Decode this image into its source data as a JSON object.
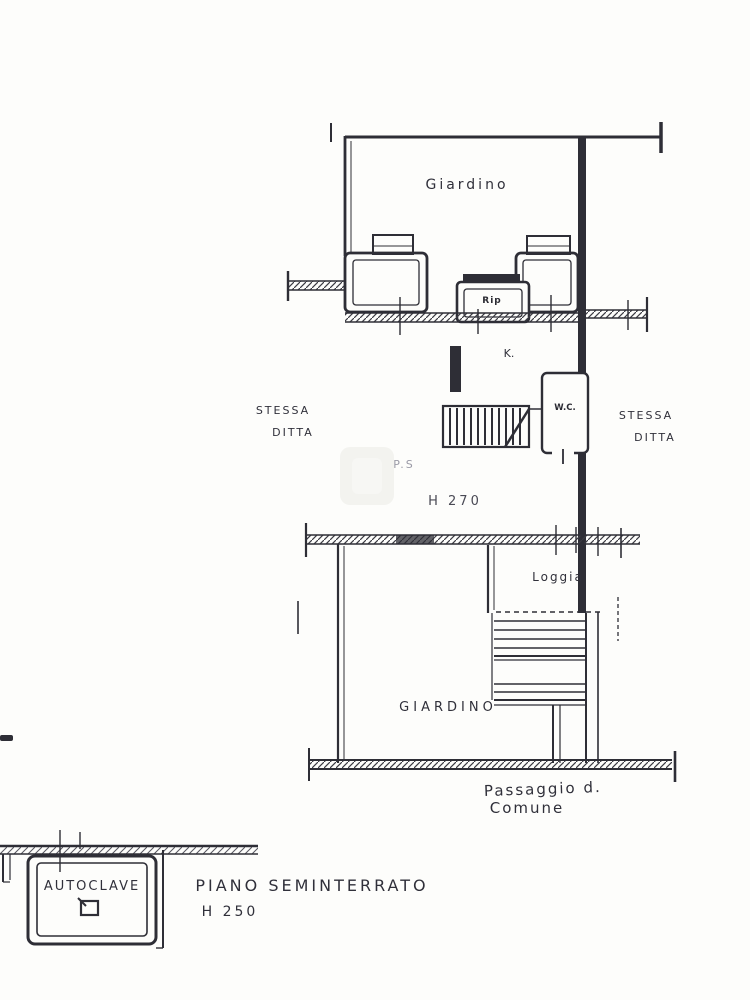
{
  "plan": {
    "labels": {
      "garden_top": "Giardino",
      "rip": "Rip",
      "kitchen": "K.",
      "wc": "W.C.",
      "stessa_left_1": "STESSA",
      "stessa_left_2": "DITTA",
      "stessa_right_1": "STESSA",
      "stessa_right_2": "DITTA",
      "room_code": "P.S",
      "room_height": "H 270",
      "loggia": "Loggia",
      "garden_bottom": "GIARDINO",
      "passage_line1": "Passaggio d.",
      "passage_line2": "Comune"
    },
    "basement": {
      "autoclave": "AUTOCLAVE",
      "floor_title": "PIANO SEMINTERRATO",
      "floor_height": "H 250"
    },
    "colors": {
      "ink": "#2e2e36",
      "faint": "#9a9aa6",
      "paper": "#fdfdfb"
    }
  }
}
